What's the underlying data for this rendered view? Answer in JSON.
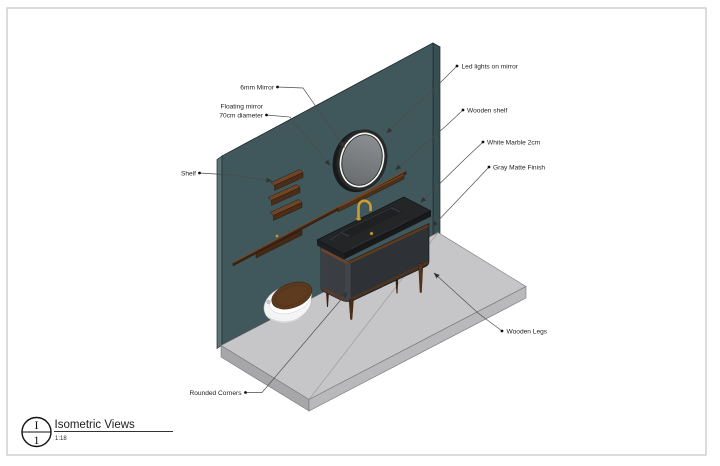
{
  "drawing": {
    "annotations": {
      "mirror_6mm": "6mm Mirror",
      "floating_mirror_line1": "Floating mirror",
      "floating_mirror_line2": "70cm diameter",
      "shelf": "Shelf",
      "led_lights": "Led lights on mirror",
      "wooden_shelf": "Wooden shelf",
      "white_marble": "White Marble 2cm",
      "gray_matte": "Gray Matte Finish",
      "wooden_legs": "Wooden Legs",
      "rounded_corners": "Rounded Corners"
    },
    "title_block": {
      "view_letter": "I",
      "view_number": "1",
      "title": "Isometric Views",
      "scale": "1:18"
    },
    "colors": {
      "wall": "#40585c",
      "wall_top": "#546c70",
      "wall_side": "#374f53",
      "wall_left": "#5a7478",
      "floor": "#c6c6c8",
      "floor_side_left": "#a7a7a9",
      "floor_side_front": "#b9b9bb",
      "marble": "#232527",
      "cabinet_front": "#2e3236",
      "cabinet_left": "#3a3e42",
      "wood": "#5e3a1e",
      "wood_light": "#6e4526",
      "gold": "#cf9c2f",
      "mirror_glass": "#77797b",
      "mirror_rim": "#26282a",
      "led_ring": "#f4f4ef",
      "toilet": "#f4f4f6",
      "line": "#4a4a4a"
    }
  }
}
